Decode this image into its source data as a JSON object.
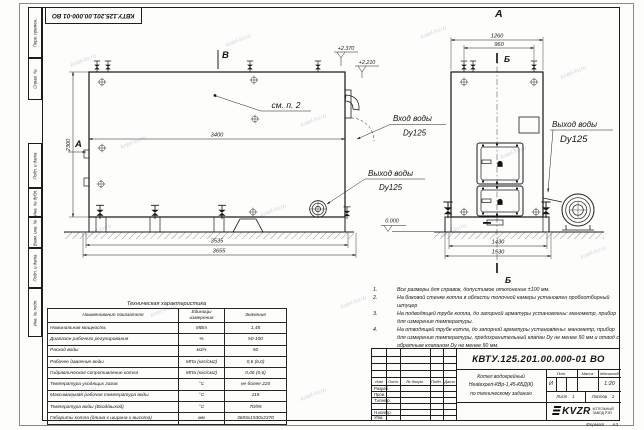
{
  "sheet": {
    "top_stamp": "КВТУ.125.201.00.000-01 ВО",
    "watermark": "kotel-kv.ru",
    "format_label": "Формат",
    "format_value": "А3",
    "margins": {
      "perv": "Перв. примен.",
      "sprav": "Справ. №",
      "podp1": "Подп. и дата",
      "inv_dubl": "Инв. № дубл.",
      "vzam": "Взам. инв. №",
      "podp2": "Подп. и дата",
      "inv_podl": "Инв. № подл."
    }
  },
  "side_view": {
    "mark_top": "В",
    "mark_left": "А",
    "callout": "см. п. 2",
    "dim_width": "3400",
    "dim_height": "2300",
    "dim_frame": "3535",
    "dim_total": "3655",
    "elev_top": "+2.370",
    "elev_mid": "+2.210",
    "inlet_title": "Вход воды",
    "inlet_dn": "Dy125",
    "outlet_title": "Выход воды",
    "outlet_dn": "Dy125"
  },
  "front_view": {
    "title": "А",
    "section_top": "Б",
    "section_bottom": "Б",
    "dim_top": "1260",
    "dim_valves": "960",
    "dim_frame": "1430",
    "dim_total": "1530",
    "elev_zero": "0.000",
    "outlet_title": "Выход воды",
    "outlet_dn": "Dy125"
  },
  "tech_table": {
    "title": "Техническая характеристика",
    "headers": [
      "Наименование показателя",
      "Единицы измерения",
      "Значение"
    ],
    "rows": [
      [
        "Номинальная мощность",
        "МВт",
        "1,45"
      ],
      [
        "Диапазон рабочего регулирования",
        "%",
        "50-100"
      ],
      [
        "Расход воды",
        "м3/ч",
        "50"
      ],
      [
        "Рабочее давление воды",
        "МПа (кгс/см2)",
        "0,6 (6,0)"
      ],
      [
        "Гидравлическое сопротивление котла",
        "МПа (кгс/см2)",
        "0,06 (0,6)"
      ],
      [
        "Температура уходящих газов",
        "°С",
        "не более 220"
      ],
      [
        "Максимальная рабочая температура воды",
        "°С",
        "115"
      ],
      [
        "Температура воды (Вход/выход)",
        "°С",
        "70/95"
      ],
      [
        "Габариты котла (длина х ширина х высота)",
        "мм",
        "3655х1530х2370"
      ]
    ]
  },
  "notes": {
    "items": [
      {
        "num": "1.",
        "text": "Все размеры для справок, допустимое отклонение ±100 мм."
      },
      {
        "num": "2.",
        "text": "На боковой стенке котла в области топочной камеры установлен пробоотборный штуцер"
      },
      {
        "num": "3.",
        "text": "На подводящей трубе котла, до запорной арматуры установлены: манометр, прибор для измерения температуры."
      },
      {
        "num": "4.",
        "text": "На отводящей трубе котла, до запорной арматуры установлены: манометр, прибор для измерения температуры, предохранительный клапан Dу не менее 50 мм и отвод с обратным клапаном Dу не менее 50 мм."
      }
    ]
  },
  "title_block": {
    "doc_number": "КВТУ.125.201.00.000-01 ВО",
    "name_line1": "Котел водогрейный",
    "name_line2": "Heatexpert-КВр-1,45-КБД(К)",
    "name_line3": "по техническому заданию",
    "col_izm": "Изм",
    "col_list": "Лист",
    "col_doc": "№ докум.",
    "col_podp": "Подп.",
    "col_data": "Дата",
    "row_razrab": "Разраб.",
    "row_prov": "Пров.",
    "row_tkontr": "Т.контр.",
    "row_nkontr": "Н.контр.",
    "row_utv": "Утв.",
    "lit_header": "Лит.",
    "mass_header": "Масса",
    "scale_header": "Масштаб",
    "lit_value": "И",
    "scale_value": "1:20",
    "sheet_label": "Лист",
    "sheet_value": "1",
    "sheets_label": "Листов",
    "sheets_value": "2",
    "company": "KVZR",
    "company_sub1": "КОТЕЛЬНЫЙ",
    "company_sub2": "ЗАВОД РЭП"
  }
}
